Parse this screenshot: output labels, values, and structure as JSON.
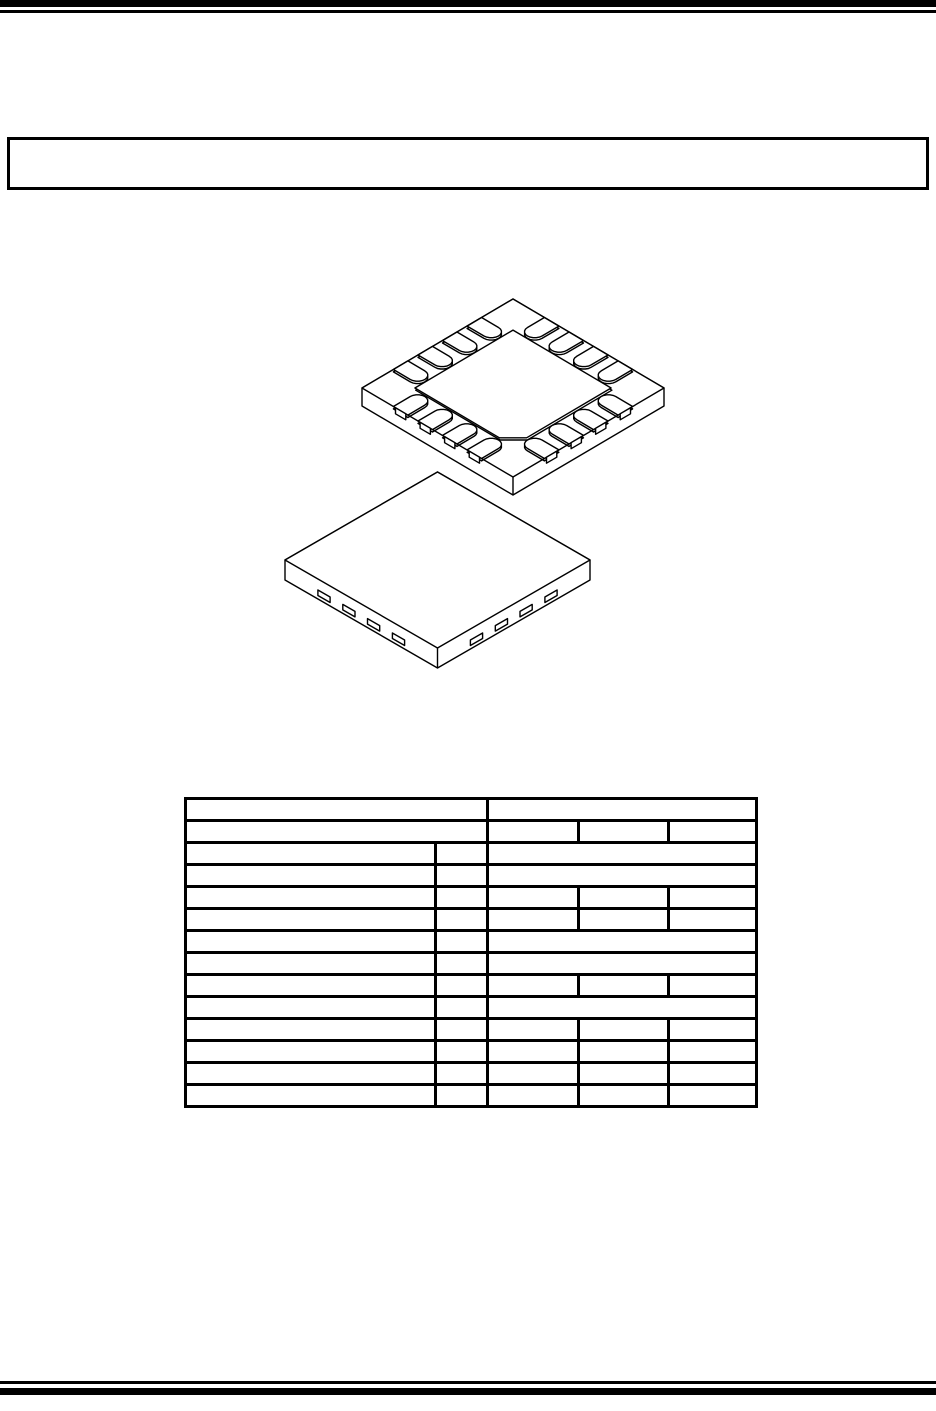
{
  "page": {
    "width": 936,
    "height": 1411,
    "background_color": "#ffffff",
    "line_color": "#000000"
  },
  "title_box": {
    "text": ""
  },
  "figures": [
    {
      "name": "qfn-package-isometric-bottom-view",
      "description": "16-contact QFN package drawn from the bottom side, exposed pad with chamfered corner, 4 rounded contacts per side"
    },
    {
      "name": "qfn-package-isometric-top-view",
      "description": "16-contact QFN package drawn from the top side, contact ends visible as small marks on the side faces"
    }
  ],
  "table": {
    "rows": [
      [
        {
          "colspan": 2,
          "text": ""
        },
        {
          "colspan": 3,
          "text": ""
        }
      ],
      [
        {
          "colspan": 2,
          "text": ""
        },
        {
          "colspan": 1,
          "text": ""
        },
        {
          "colspan": 1,
          "text": ""
        },
        {
          "colspan": 1,
          "text": ""
        }
      ],
      [
        {
          "colspan": 1,
          "text": ""
        },
        {
          "colspan": 1,
          "text": ""
        },
        {
          "colspan": 3,
          "text": ""
        }
      ],
      [
        {
          "colspan": 1,
          "text": ""
        },
        {
          "colspan": 1,
          "text": ""
        },
        {
          "colspan": 3,
          "text": ""
        }
      ],
      [
        {
          "colspan": 1,
          "text": ""
        },
        {
          "colspan": 1,
          "text": ""
        },
        {
          "colspan": 1,
          "text": ""
        },
        {
          "colspan": 1,
          "text": ""
        },
        {
          "colspan": 1,
          "text": ""
        }
      ],
      [
        {
          "colspan": 1,
          "text": ""
        },
        {
          "colspan": 1,
          "text": ""
        },
        {
          "colspan": 1,
          "text": ""
        },
        {
          "colspan": 1,
          "text": ""
        },
        {
          "colspan": 1,
          "text": ""
        }
      ],
      [
        {
          "colspan": 1,
          "text": ""
        },
        {
          "colspan": 1,
          "text": ""
        },
        {
          "colspan": 3,
          "text": ""
        }
      ],
      [
        {
          "colspan": 1,
          "text": ""
        },
        {
          "colspan": 1,
          "text": ""
        },
        {
          "colspan": 3,
          "text": ""
        }
      ],
      [
        {
          "colspan": 1,
          "text": ""
        },
        {
          "colspan": 1,
          "text": ""
        },
        {
          "colspan": 1,
          "text": ""
        },
        {
          "colspan": 1,
          "text": ""
        },
        {
          "colspan": 1,
          "text": ""
        }
      ],
      [
        {
          "colspan": 1,
          "text": ""
        },
        {
          "colspan": 1,
          "text": ""
        },
        {
          "colspan": 3,
          "text": ""
        }
      ],
      [
        {
          "colspan": 1,
          "text": ""
        },
        {
          "colspan": 1,
          "text": ""
        },
        {
          "colspan": 1,
          "text": ""
        },
        {
          "colspan": 1,
          "text": ""
        },
        {
          "colspan": 1,
          "text": ""
        }
      ],
      [
        {
          "colspan": 1,
          "text": ""
        },
        {
          "colspan": 1,
          "text": ""
        },
        {
          "colspan": 1,
          "text": ""
        },
        {
          "colspan": 1,
          "text": ""
        },
        {
          "colspan": 1,
          "text": ""
        }
      ],
      [
        {
          "colspan": 1,
          "text": ""
        },
        {
          "colspan": 1,
          "text": ""
        },
        {
          "colspan": 1,
          "text": ""
        },
        {
          "colspan": 1,
          "text": ""
        },
        {
          "colspan": 1,
          "text": ""
        }
      ],
      [
        {
          "colspan": 1,
          "text": ""
        },
        {
          "colspan": 1,
          "text": ""
        },
        {
          "colspan": 1,
          "text": ""
        },
        {
          "colspan": 1,
          "text": ""
        },
        {
          "colspan": 1,
          "text": ""
        }
      ]
    ]
  }
}
